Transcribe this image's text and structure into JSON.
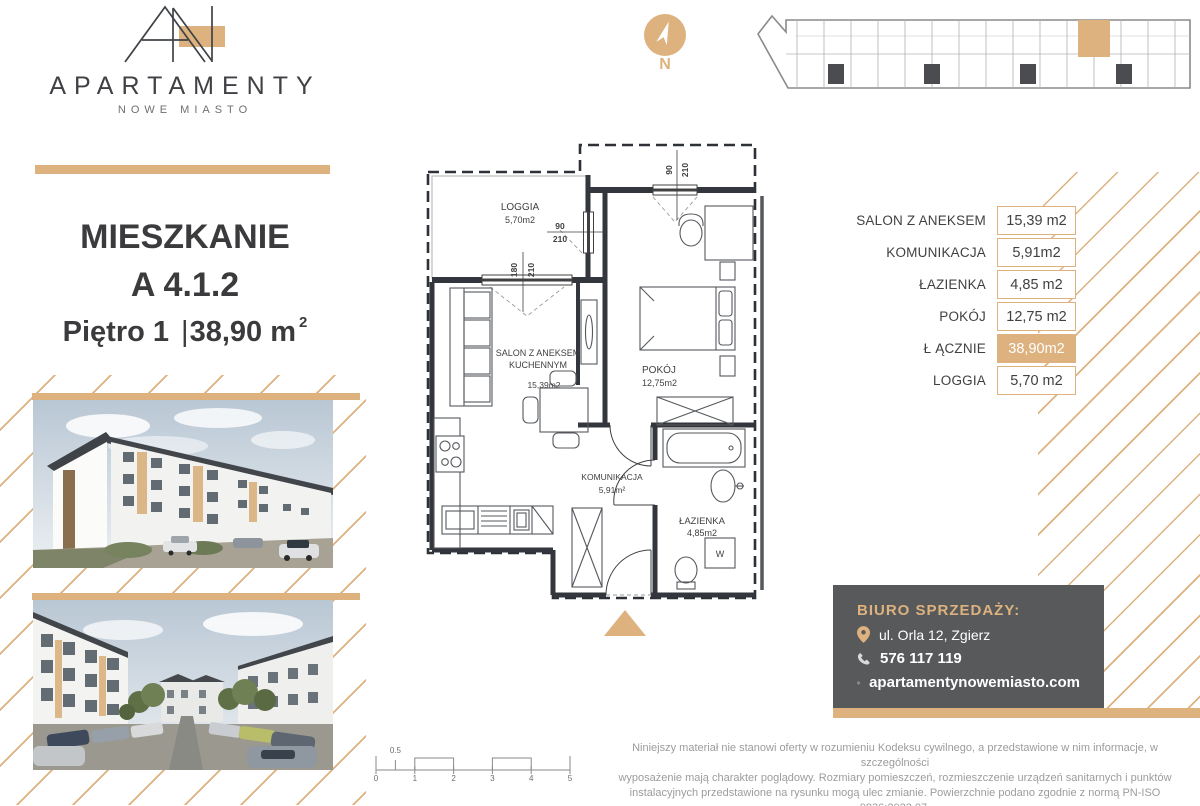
{
  "brand": {
    "name": "APARTAMENTY",
    "subtitle": "NOWE MIASTO"
  },
  "listing": {
    "type_label": "MIESZKANIE",
    "unit_number": "A 4.1.2",
    "floor_label": "Piętro 1",
    "separator": "|",
    "area_value": "38,90 m",
    "area_superscript": "2"
  },
  "compass": {
    "north_label": "N"
  },
  "floor_plan": {
    "rooms": {
      "loggia": {
        "name": "LOGGIA",
        "area": "5,70m2"
      },
      "salon": {
        "name_line1": "SALON Z ANEKSEM",
        "name_line2": "KUCHENNYM",
        "area": "15,39m2"
      },
      "pokoj": {
        "name": "POKÓJ",
        "area": "12,75m2"
      },
      "komunikacja": {
        "name": "KOMUNIKACJA",
        "area": "5,91m²"
      },
      "lazienka": {
        "name": "ŁAZIENKA",
        "area": "4,85m2"
      }
    },
    "washer_label": "W",
    "dimensions": [
      {
        "width": "180",
        "height": "210"
      },
      {
        "width": "90",
        "height": "210"
      },
      {
        "width": "90",
        "height": "210"
      }
    ]
  },
  "area_table": {
    "rows": [
      {
        "label": "SALON Z ANEKSEM",
        "value": "15,39 m2"
      },
      {
        "label": "KOMUNIKACJA",
        "value": "5,91m2"
      },
      {
        "label": "ŁAZIENKA",
        "value": "4,85 m2"
      },
      {
        "label": "POKÓJ",
        "value": "12,75 m2"
      },
      {
        "label": "Ł ĄCZNIE",
        "value": "38,90m2"
      },
      {
        "label": "LOGGIA",
        "value": "5,70 m2"
      }
    ]
  },
  "sales_office": {
    "title": "BIURO SPRZEDAŻY:",
    "address": "ul. Orla 12, Zgierz",
    "phone": "576 117 119",
    "website": "apartamentynowemiasto.com"
  },
  "scale_bar": {
    "ticks": [
      "0",
      "1",
      "2",
      "3",
      "4",
      "5"
    ],
    "half_label": "0.5"
  },
  "disclaimer": {
    "line1": "Niniejszy materiał nie stanowi oferty w rozumieniu Kodeksu cywilnego, a przedstawione w nim informacje, w szczególności",
    "line2": "wyposażenie mają charakter poglądowy. Rozmiary pomieszczeń, rozmieszczenie urządzeń sanitarnych i punktów",
    "line3": "instalacyjnych przedstawione na rysunku mogą ulec zmianie. Powierzchnie podano zgodnie z normą PN-ISO 9836:2022.07."
  },
  "colors": {
    "gold": "#DDB27E",
    "dark_panel": "#58595B",
    "ink": "#414042"
  }
}
